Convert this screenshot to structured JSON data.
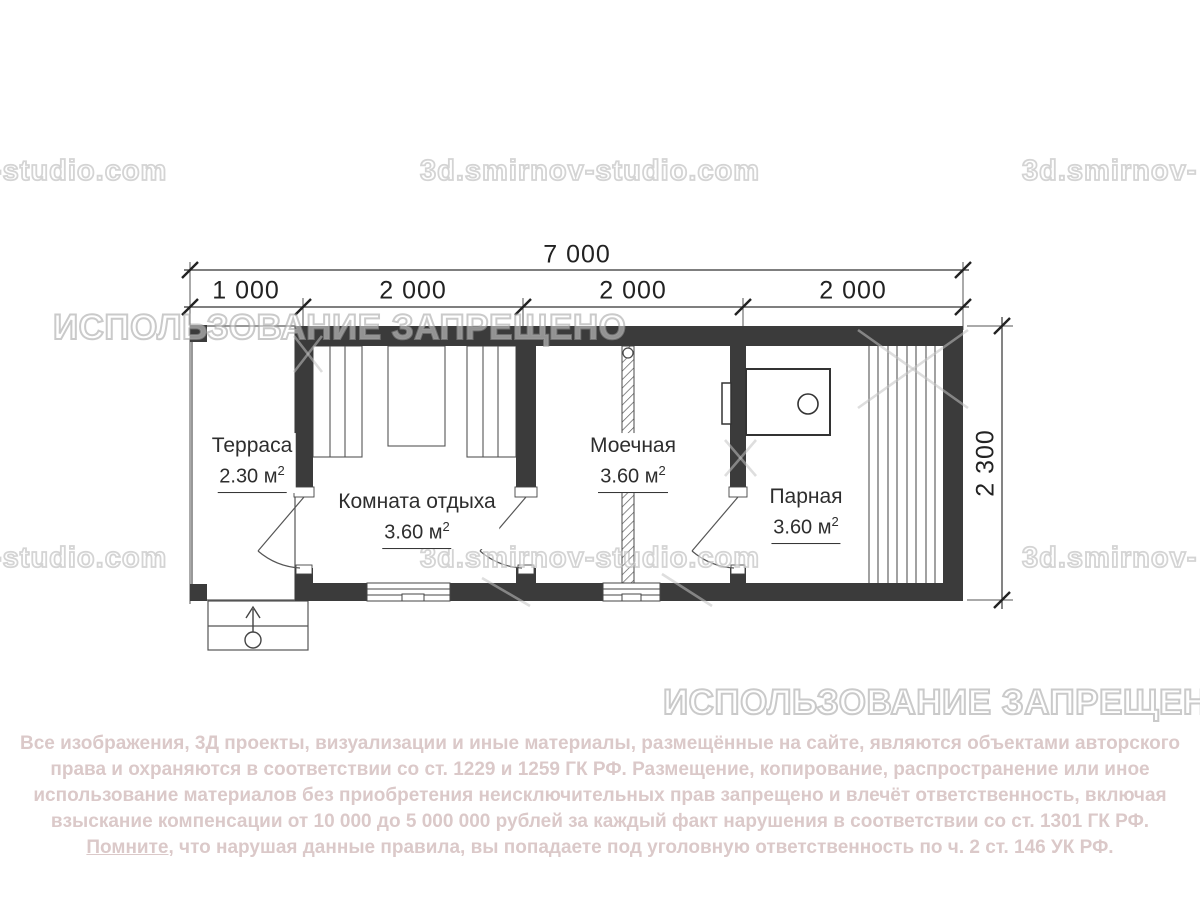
{
  "watermarks": {
    "site_left_partial": "-studio.com",
    "site_full": "3d.smirnov-studio.com",
    "site_right_partial": "3d.smirnov-",
    "prohibited": "ИСПОЛЬЗОВАНИЕ ЗАПРЕЩЕНО"
  },
  "dimensions": {
    "total": "7 000",
    "seg1": "1 000",
    "seg2": "2 000",
    "seg3": "2 000",
    "seg4": "2 000",
    "height": "2 300"
  },
  "rooms": {
    "terrace": {
      "name": "Терраса",
      "area": "2.30 м",
      "sup": "2"
    },
    "rest": {
      "name": "Комната отдыха",
      "area": "3.60 м",
      "sup": "2"
    },
    "wash": {
      "name": "Моечная",
      "area": "3.60 м",
      "sup": "2"
    },
    "steam": {
      "name": "Парная",
      "area": "3.60 м",
      "sup": "2"
    }
  },
  "footer": {
    "line1": "Все изображения, 3Д проекты, визуализации и иные материалы, размещённые на сайте, являются объектами авторского",
    "line2": "права и охраняются в соответствии со ст. 1229 и 1259 ГК РФ. Размещение, копирование, распространение или иное",
    "line3": "использование материалов без приобретения неисключительных прав запрещено и влечёт ответственность, включая",
    "line4": "взыскание компенсации от 10 000 до 5 000 000 рублей за каждый факт нарушения в соответствии со ст. 1301 ГК РФ.",
    "line5_underlined": "Помните,",
    "line5_rest": " что нарушая данные правила, вы попадаете под уголовную ответственность по ч. 2 ст. 146 УК РФ."
  },
  "colors": {
    "wall": "#3b3b3b",
    "line": "#4a4a4a",
    "dim": "#222222",
    "footer_text": "#dbc9c9",
    "watermark": "#bababa"
  }
}
